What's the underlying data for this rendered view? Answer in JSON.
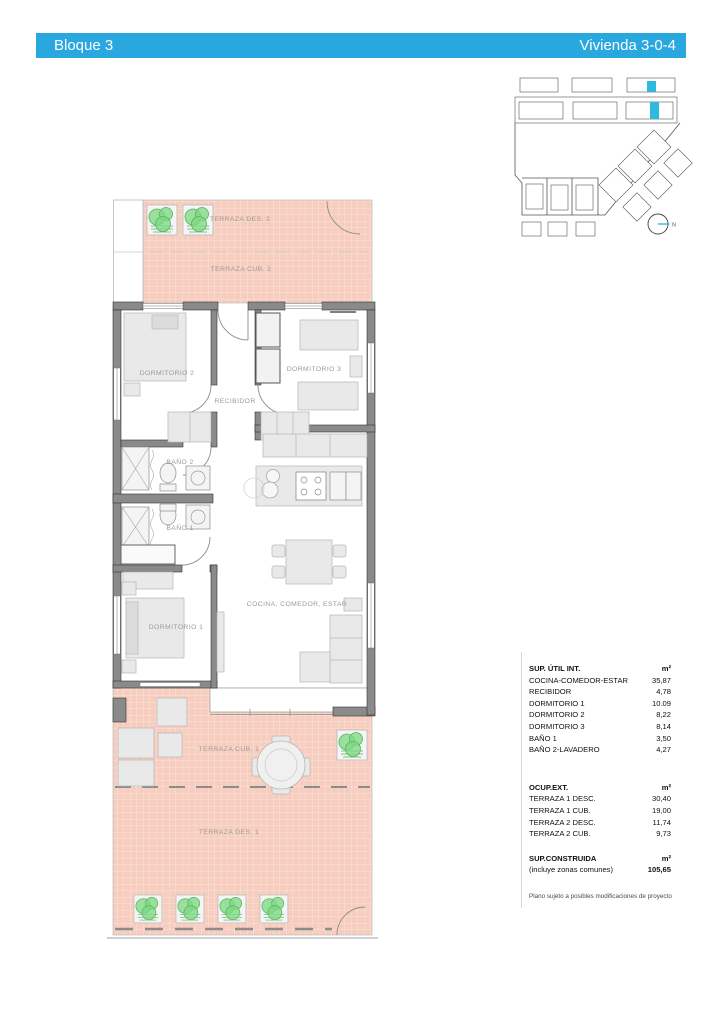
{
  "header": {
    "left": "Bloque 3",
    "right": "Vivienda 3-0-4",
    "accent_color": "#29a8e0"
  },
  "keyplan": {
    "north_label": "N",
    "highlight_color": "#2fb9dc"
  },
  "plan": {
    "colors": {
      "terrace": "#f7cdbf",
      "wall": "#8a8a8a",
      "plant": "#7fd884"
    },
    "rooms": {
      "terraza_des_2": "TERRAZA DES. 2",
      "terraza_cub_2": "TERRAZA CUB. 2",
      "dormitorio_2": "DORMITORIO 2",
      "dormitorio_3": "DORMITORIO 3",
      "recibidor": "RECIBIDOR",
      "bano_2": "BAÑO 2",
      "bano_1": "BAÑO 1",
      "dormitorio_1": "DORMITORIO 1",
      "cocina": "COCINA, COMEDOR, ESTAR",
      "terraza_cub_1": "TERRAZA CUB. 1",
      "terraza_des_1": "TERRAZA DES. 1"
    }
  },
  "areas": {
    "util": {
      "title": "SUP. ÚTIL INT.",
      "unit": "m²",
      "rows": [
        {
          "label": "COCINA-COMEDOR-ESTAR",
          "value": "35,87"
        },
        {
          "label": "RECIBIDOR",
          "value": "4,78"
        },
        {
          "label": "DORMITORIO 1",
          "value": "10.09"
        },
        {
          "label": "DORMITORIO 2",
          "value": "8,22"
        },
        {
          "label": "DORMITORIO 3",
          "value": "8,14"
        },
        {
          "label": "BAÑO 1",
          "value": "3,50"
        },
        {
          "label": "BAÑO 2-LAVADERO",
          "value": "4,27"
        }
      ]
    },
    "ext": {
      "title": "OCUP.EXT.",
      "unit": "m²",
      "rows": [
        {
          "label": "TERRAZA 1 DESC.",
          "value": "30,40"
        },
        {
          "label": "TERRAZA 1 CUB.",
          "value": "19,00"
        },
        {
          "label": "TERRAZA 2 DESC.",
          "value": "11,74"
        },
        {
          "label": "TERRAZA 2 CUB.",
          "value": "9,73"
        }
      ]
    },
    "construida": {
      "title": "SUP.CONSTRUIDA",
      "unit": "m²",
      "subtitle": "(incluye zonas comunes)",
      "value": "105,65"
    }
  },
  "footer_note": "Plano sujeto a posibles modificaciones de proyecto"
}
